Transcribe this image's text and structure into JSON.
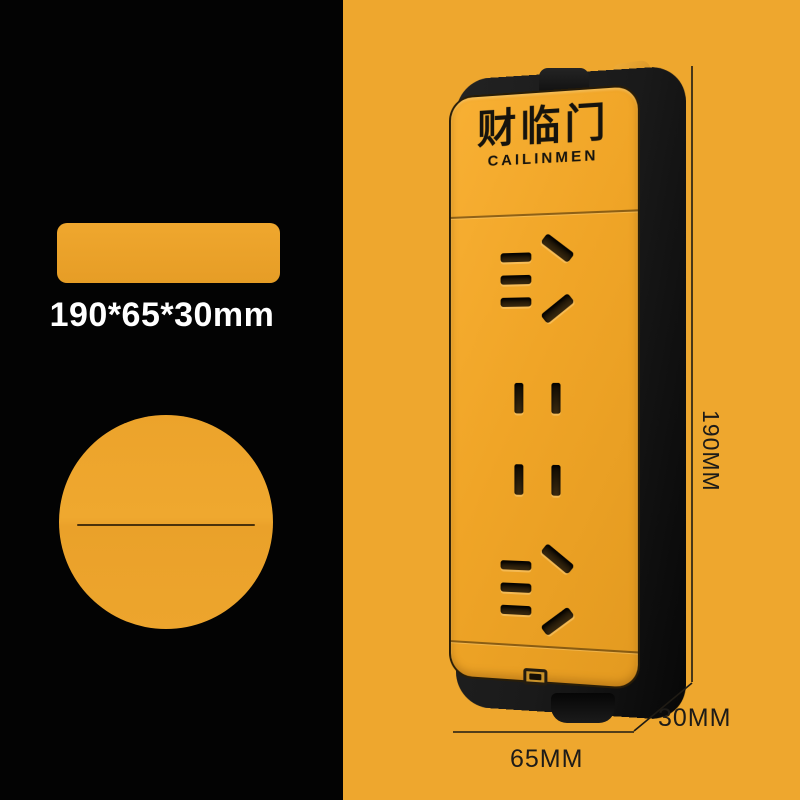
{
  "left_panel": {
    "size_caption": "190*65*30mm"
  },
  "product": {
    "brand_cn": "财临门",
    "brand_en": "CAILINMEN"
  },
  "dimensions": {
    "height_label": "190MM",
    "depth_label": "30MM",
    "width_label": "65MM"
  },
  "colors": {
    "background_orange": "#EEA72E",
    "panel_black": "#030303",
    "product_face_orange": "#F0A527",
    "product_body_black": "#161616",
    "swatch_orange": "#EDA32C",
    "caption_white": "#FFFFFF",
    "dimension_line_dark": "#1F1B14"
  }
}
